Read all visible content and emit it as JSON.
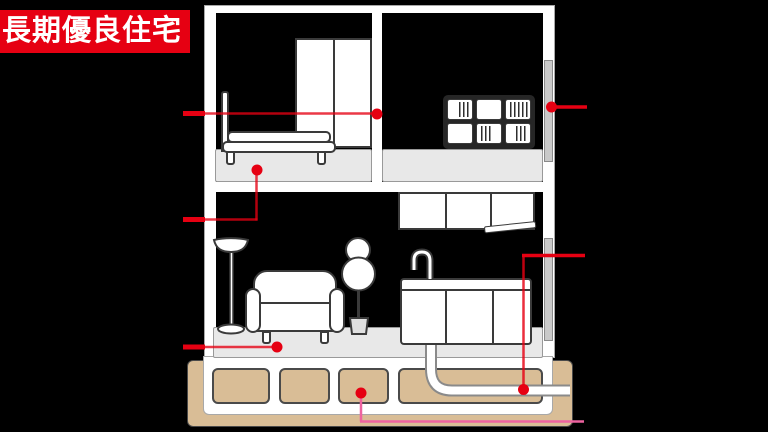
{
  "badge": {
    "label": "長期優良住宅",
    "bg_color": "#e60012",
    "text_color": "#ffffff"
  },
  "colors": {
    "accent_red": "#e60012",
    "callout_pink": "#ee639f",
    "ground_tan": "#d9bd96",
    "floor_slab_gray": "#e8e8e8",
    "insulation_gray": "#c9c9c9",
    "wall_white": "#ffffff",
    "room_black": "#000000"
  },
  "diagram": {
    "type": "house-cross-section",
    "floors": [
      "2F bedroom",
      "2F storage room",
      "1F living-kitchen",
      "foundation"
    ],
    "furniture": [
      "bed",
      "wardrobe",
      "bookshelf",
      "wall-cabinet",
      "kitchen-sink",
      "faucet",
      "sofa",
      "floor-lamp",
      "plant",
      "drain-pipe",
      "foundation-blocks"
    ],
    "callouts": [
      {
        "id": "A",
        "color": "#e60012",
        "dot": {
          "x": 377,
          "y": 114
        },
        "points_to": "2f-partition-wall"
      },
      {
        "id": "B",
        "color": "#e60012",
        "dot": {
          "x": 257,
          "y": 170
        },
        "points_to": "2f-floor-slab"
      },
      {
        "id": "C",
        "color": "#e60012",
        "dot": {
          "x": 277,
          "y": 347
        },
        "points_to": "1f-floor-slab"
      },
      {
        "id": "D",
        "color": "#e60012",
        "dot": {
          "x": 551,
          "y": 107
        },
        "points_to": "exterior-wall-insulation"
      },
      {
        "id": "E",
        "color": "#e60012",
        "dot": {
          "x": 523,
          "y": 390
        },
        "points_to": "drain-pipe"
      },
      {
        "id": "F",
        "color": "#ee639f",
        "dot": {
          "x": 361,
          "y": 393
        },
        "points_to": "foundation-block"
      }
    ]
  }
}
